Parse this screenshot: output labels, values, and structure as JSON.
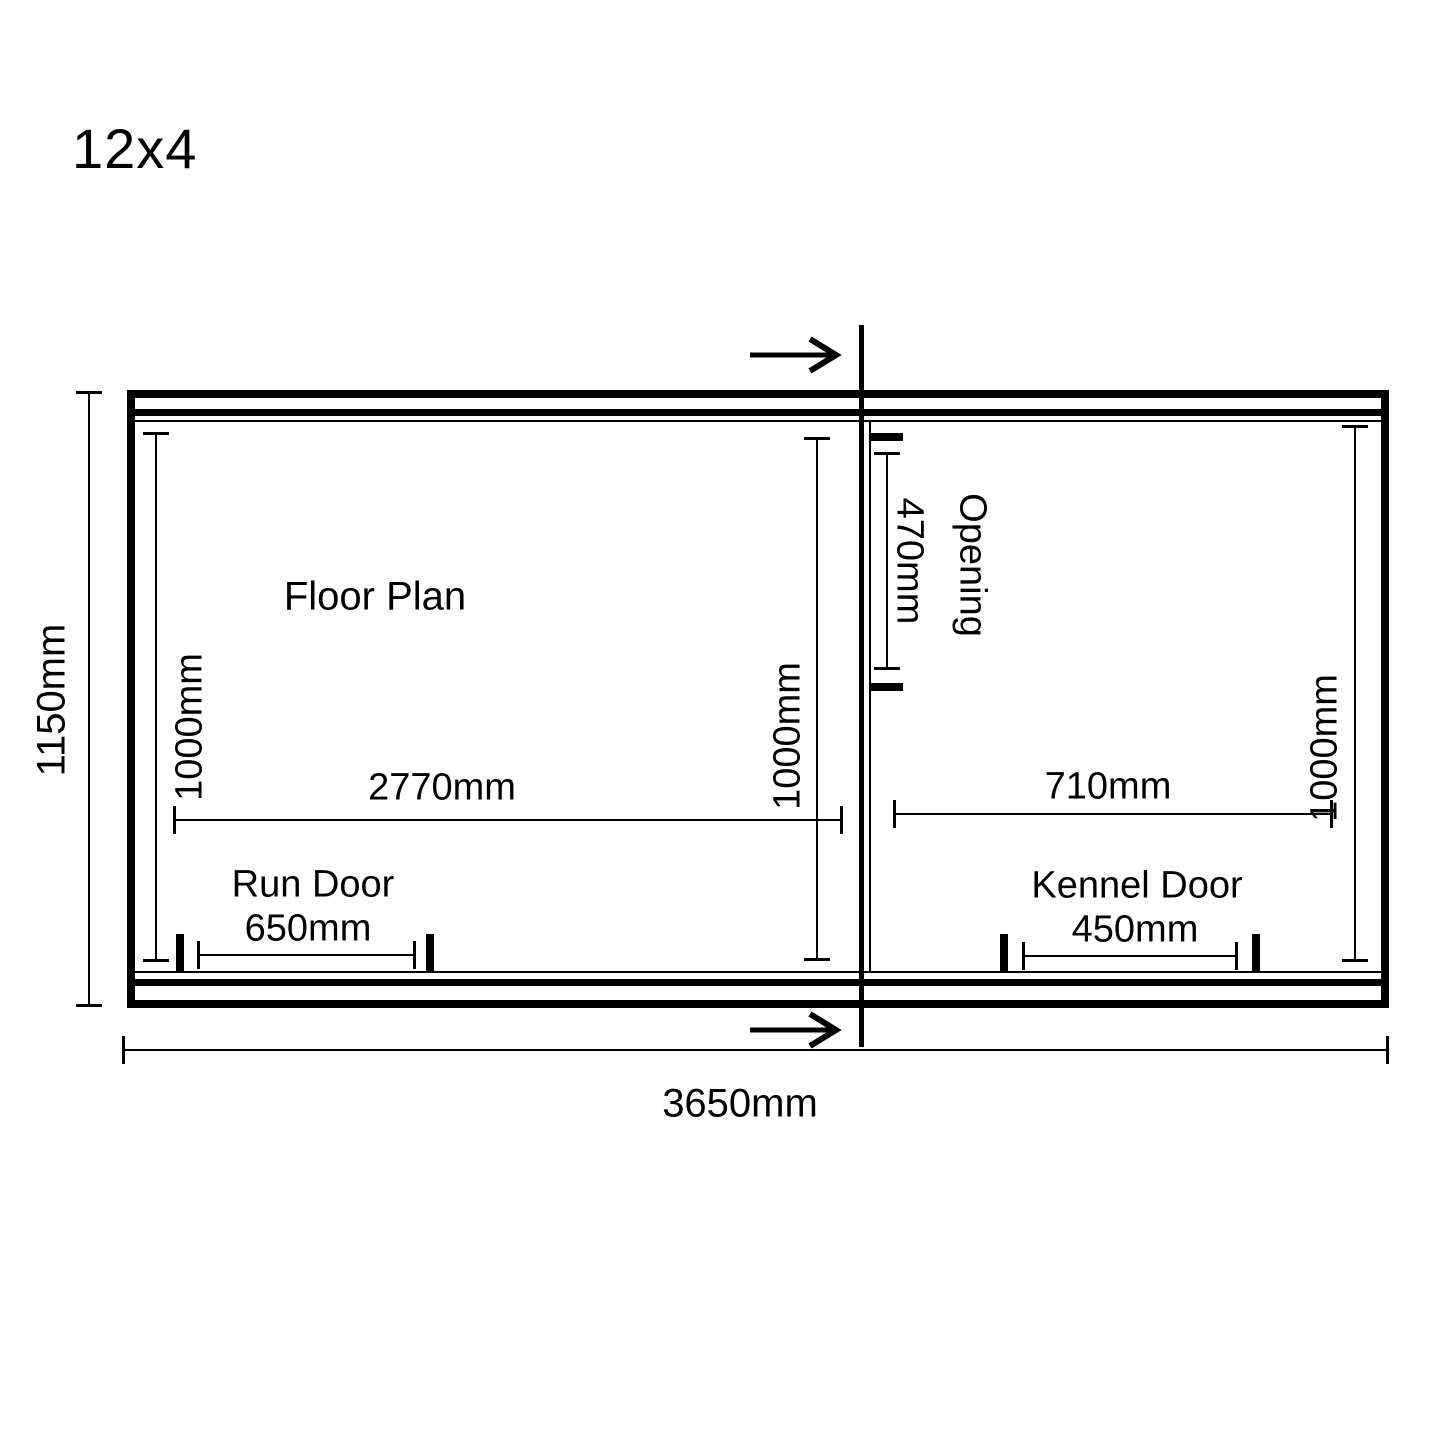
{
  "meta": {
    "title": "12x4"
  },
  "labels": {
    "floor_plan": "Floor Plan",
    "opening": "Opening",
    "run_door": "Run Door",
    "kennel_door": "Kennel Door"
  },
  "dimensions": {
    "overall_length": "3650mm",
    "overall_depth": "1150mm",
    "run_inner_width": "2770mm",
    "kennel_inner_width": "710mm",
    "run_depth_left": "1000mm",
    "run_depth_right": "1000mm",
    "kennel_depth": "1000mm",
    "opening_width": "470mm",
    "run_door_width": "650mm",
    "kennel_door_width": "450mm"
  },
  "colors": {
    "ink": "#000000",
    "paper": "#ffffff"
  }
}
